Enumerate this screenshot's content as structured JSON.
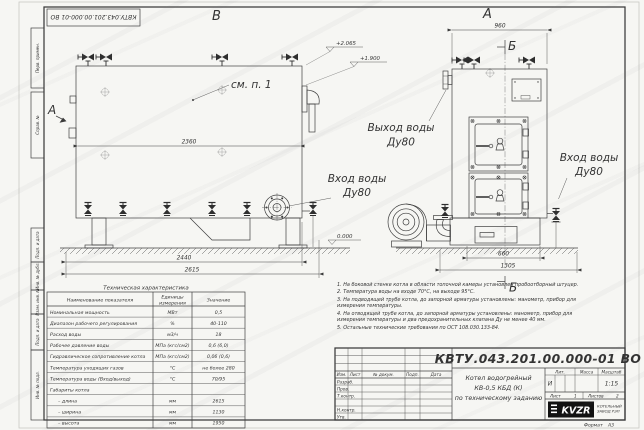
{
  "colors": {
    "ink": "#3a3a3a",
    "paper": "#f6f6f3",
    "logo_bg": "#111111"
  },
  "sheet": {
    "stamp_top": "КВТУ.043.201.00.000-01 ВО",
    "format_label": "Формат",
    "format_value": "А3"
  },
  "frame_labels": [
    "Перв. примен.",
    "Справ. №",
    "Подп. и дата",
    "Инв. № дубл.",
    "Взам. инв. №",
    "Подп. и дата",
    "Инв. № подл."
  ],
  "views": {
    "side": {
      "label": "В",
      "section_arrow_label": "А",
      "see_note": "см. п. 1",
      "dim_width": "2360",
      "dim_base": "2440",
      "dim_overall": "2615",
      "elev_top": "+2.065",
      "elev_mid": "+1.900",
      "elev_zero": "0.000",
      "inlet_label": "Вход воды",
      "inlet_dn": "Ду80"
    },
    "front": {
      "label": "А",
      "section_mark": "Б",
      "dim_top": "960",
      "dim_base": "660",
      "dim_overall": "1305",
      "outlet_label": "Выход воды",
      "outlet_dn": "Ду80",
      "inlet_label": "Вход воды",
      "inlet_dn": "Ду80"
    }
  },
  "tech_table": {
    "title": "Техническая характеристика",
    "headers": [
      "Наименование показателя",
      "Единицы",
      "измерения",
      "Значение"
    ],
    "rows": [
      [
        "Номинальная мощность",
        "МВт",
        "0,5"
      ],
      [
        "Диапазон рабочего регулирования",
        "%",
        "40-110"
      ],
      [
        "Расход воды",
        "м3/ч",
        "18"
      ],
      [
        "Рабочее давление воды",
        "МПа (кгс/см2)",
        "0,6 (6,0)"
      ],
      [
        "Гидравлическое сопротивление котла",
        "МПа (кгс/см2)",
        "0,06 (0,6)"
      ],
      [
        "Температура уходящих газов",
        "°С",
        "не более 280"
      ],
      [
        "Температура воды (Вход/выход)",
        "°С",
        "70/95"
      ],
      [
        "Габариты котла",
        "",
        ""
      ],
      [
        "– длина",
        "мм",
        "2615"
      ],
      [
        "– ширина",
        "мм",
        "1130"
      ],
      [
        "– высота",
        "мм",
        "1950"
      ]
    ]
  },
  "notes": [
    "1. На боковой стенке котла в области топочной камеры установлен пробоотборный штуцер.",
    "2. Температура воды на входе 70°С, на выходе 95°С.",
    "3. На подводящей трубе котла, до запорной арматуры установлены: манометр, прибор для измерения температуры.",
    "4. На отводящей трубе котла, до запорной арматуры установлены: манометр, прибор для измерения температуры и два предохранительных клапана Ду не менее 40 мм.",
    "5. Остальные технические требования по ОСТ 108.030.133-84."
  ],
  "title_block": {
    "doc_number": "КВТУ.043.201.00.000-01 ВО",
    "product_line1": "Котел водогрейный",
    "product_line2": "КВ-0,5 КБД (К)",
    "product_line3": "по техническому заданию",
    "header_cols": [
      "Изм.",
      "Лист",
      "№ докум.",
      "Подп.",
      "Дата"
    ],
    "sign_rows": [
      "Разраб.",
      "Пров.",
      "Т.контр.",
      "Н.контр.",
      "Утв."
    ],
    "lit_label": "Лит.",
    "mass_label": "Масса",
    "scale_label": "Масштаб",
    "lit_value": "И",
    "scale_value": "1:15",
    "sheet_label": "Лист",
    "sheet_value": "1",
    "sheets_label": "Листов",
    "sheets_value": "2",
    "logo_text": "KVZR",
    "company_line1": "КОТЕЛЬНЫЙ",
    "company_line2": "ЗАВОД РЭП"
  }
}
